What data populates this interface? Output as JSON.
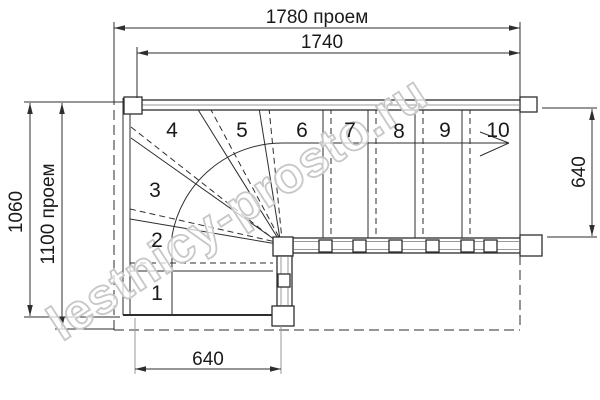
{
  "drawing": {
    "type": "staircase-floor-plan",
    "watermark": "lestnicy-prosto.ru"
  },
  "dimensions": {
    "top_opening": "1780 проем",
    "top_stair_width": "1740",
    "left_overall": "1060",
    "left_opening": "1100 проем",
    "right_flight_width": "640",
    "bottom_step_width": "640"
  },
  "steps": {
    "labels": [
      "1",
      "2",
      "3",
      "4",
      "5",
      "6",
      "7",
      "8",
      "9",
      "10"
    ]
  },
  "colors": {
    "line": "#2e2e2e",
    "secondary_line": "#9a9a9a",
    "watermark_stroke": "#c7c7c7",
    "background": "#ffffff"
  }
}
